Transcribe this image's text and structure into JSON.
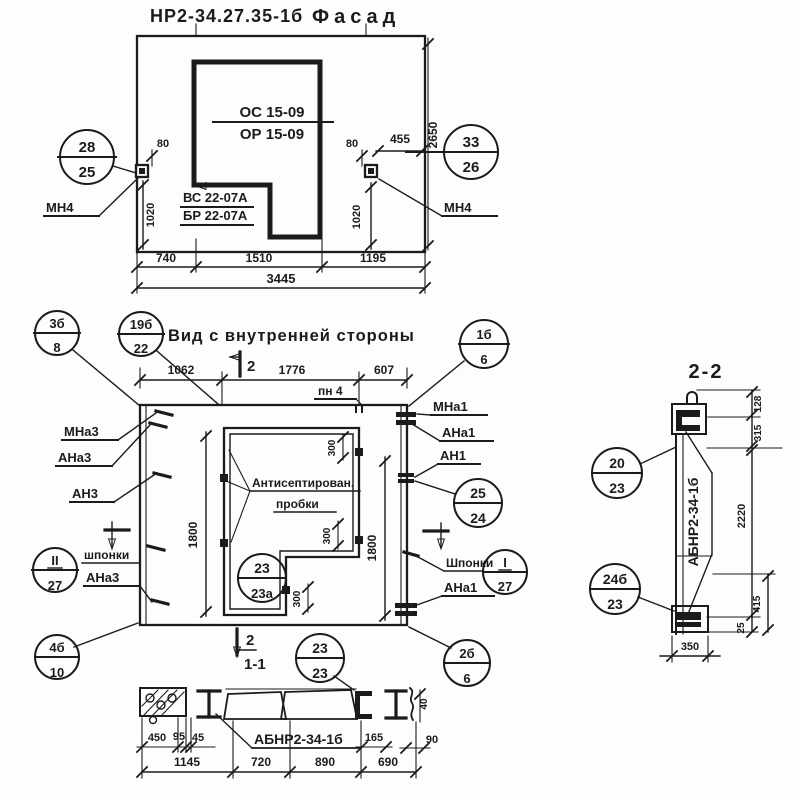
{
  "drawing": {
    "facade": {
      "title_code": "НР2-34.27.35-1б",
      "title_name": "Фасад",
      "callout_left_top": "28",
      "callout_left_bottom": "25",
      "callout_right_top": "33",
      "callout_right_bottom": "26",
      "anchor_left": "МН4",
      "anchor_right": "МН4",
      "stamp_top": "ОС 15-09",
      "stamp_bottom": "ОР 15-09",
      "stamp2_top": "ВС 22-07А",
      "stamp2_bottom": "БР 22-07А",
      "dim_80_left": "80",
      "dim_80_right": "80",
      "dim_455": "455",
      "dim_2650": "2650",
      "dim_1020_left": "1020",
      "dim_1020_right": "1020",
      "dim_740": "740",
      "dim_1510": "1510",
      "dim_1195": "1195",
      "dim_3445": "3445"
    },
    "inner": {
      "title": "Вид с внутренней стороны",
      "callout_3b_top": "3б",
      "callout_3b_bottom": "8",
      "callout_19b_top": "19б",
      "callout_19b_bottom": "22",
      "callout_1b_top": "1б",
      "callout_1b_bottom": "6",
      "callout_ii_top": "II",
      "callout_ii_bottom": "27",
      "callout_25_top": "25",
      "callout_25_bottom": "24",
      "callout_i_top": "I",
      "callout_i_bottom": "27",
      "callout_23a_top": "23",
      "callout_23a_bottom": "23а",
      "callout_4b_top": "4б",
      "callout_4b_bottom": "10",
      "callout_23_top": "23",
      "callout_23_bottom": "23",
      "callout_2b_top": "2б",
      "callout_2b_bottom": "6",
      "dim_1062": "1062",
      "dim_1776": "1776",
      "dim_607": "607",
      "label_pn4": "пн 4",
      "label_mna3": "МНа3",
      "label_ana3_top": "АНа3",
      "label_an3": "АН3",
      "label_shponki_left": "шпонки",
      "label_ana3_bottom": "АНа3",
      "label_mna1": "МНа1",
      "label_ana1_top": "АНа1",
      "label_an1": "АН1",
      "label_shponki_right": "Шпонки",
      "label_ana1_bottom": "АНа1",
      "note_line1": "Антисептирован.",
      "note_line2": "пробки",
      "dim_1800_left": "1800",
      "dim_1800_right": "1800",
      "dim_300_top": "300",
      "dim_300_mid": "300",
      "dim_300_bottom": "300",
      "marker_top": "2",
      "marker_bottom": "2",
      "section_ref": "1-1"
    },
    "section11": {
      "beam_label": "АБНР2-34-1б",
      "dim_450": "450",
      "dim_95": "95",
      "dim_45": "45",
      "dim_165": "165",
      "dim_90": "90",
      "dim_40": "40",
      "dim_1145": "1145",
      "dim_720": "720",
      "dim_890": "890",
      "dim_690": "690"
    },
    "section22": {
      "title": "2-2",
      "beam_label": "АБНР2-34-1б",
      "callout_20_top": "20",
      "callout_20_bottom": "23",
      "callout_24b_top": "24б",
      "callout_24b_bottom": "23",
      "dim_128": "128",
      "dim_315": "315",
      "dim_2220": "2220",
      "dim_415": "415",
      "dim_25": "25",
      "dim_350": "350"
    }
  }
}
